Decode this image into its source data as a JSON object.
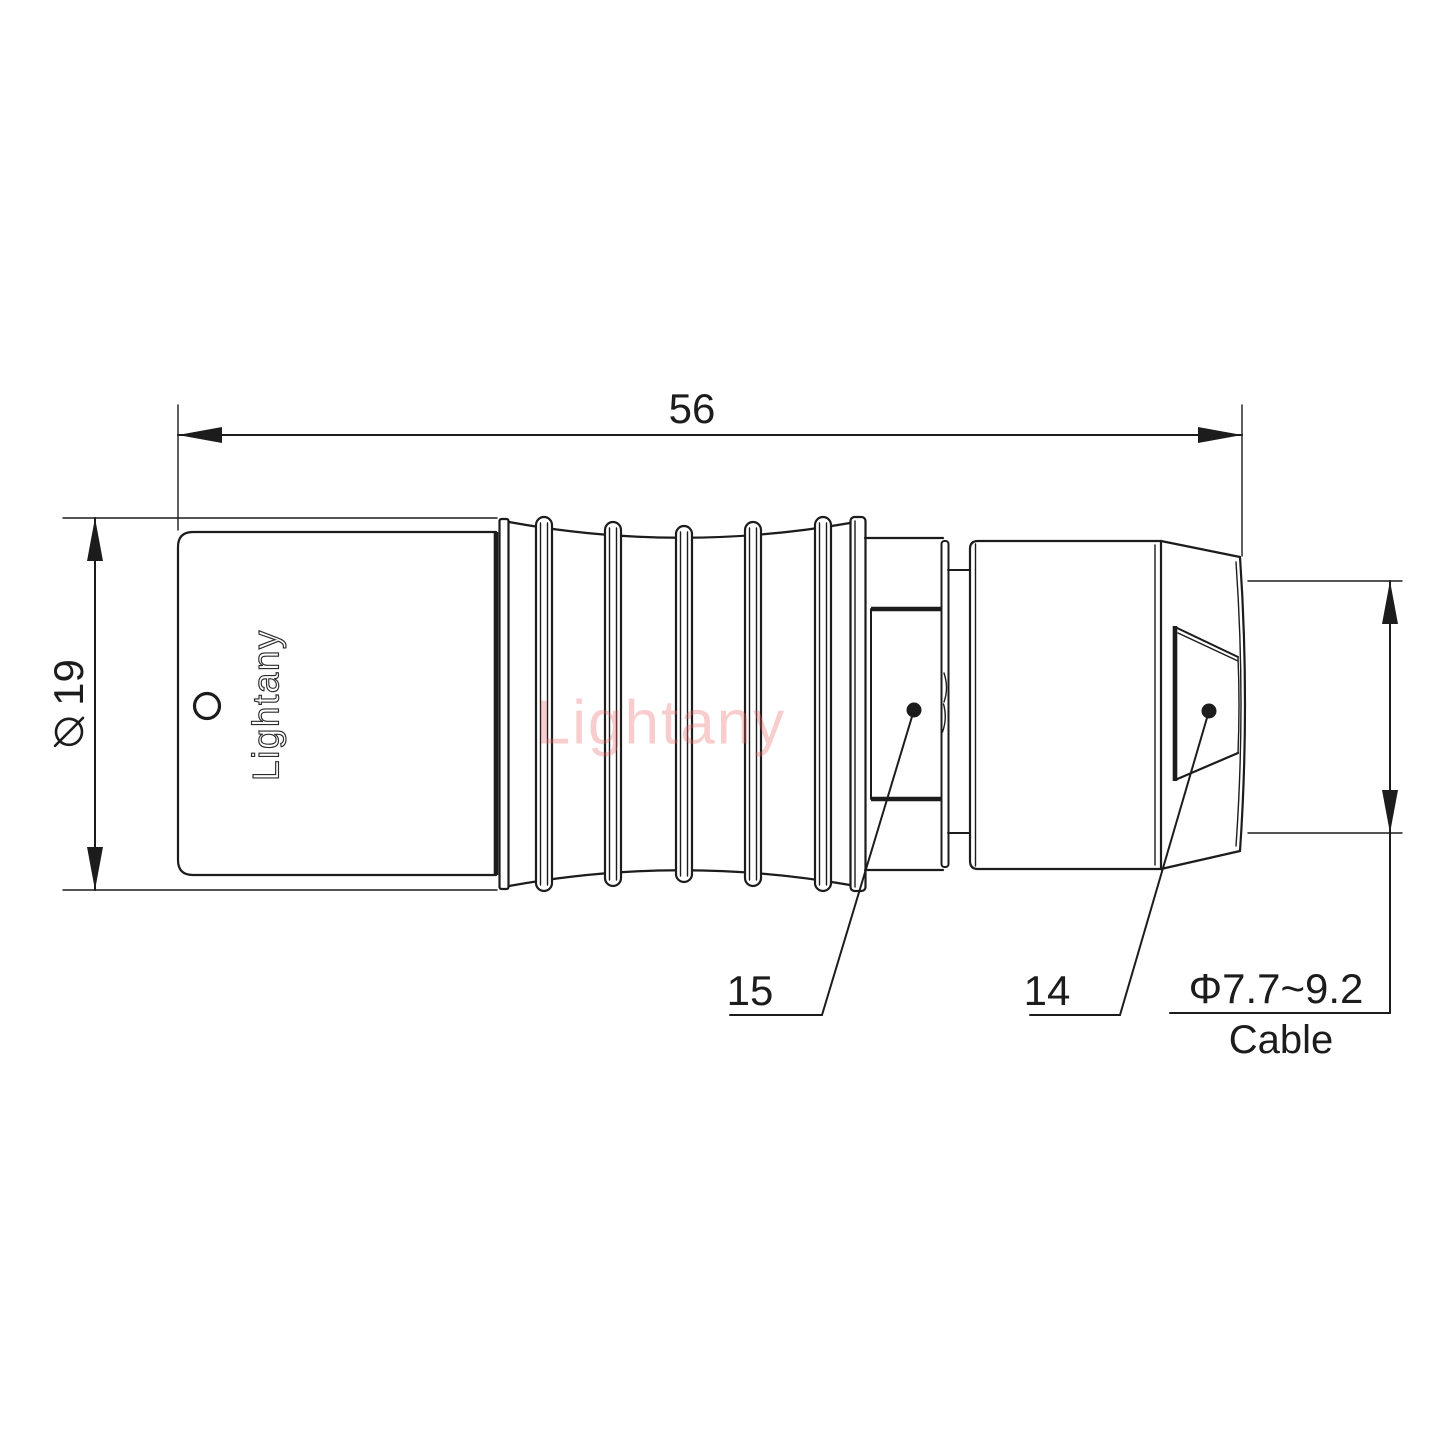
{
  "theme": {
    "bg": "#ffffff",
    "line": "#1c1c1c",
    "watermark": "rgba(233,103,103,0.33)"
  },
  "dimensions": {
    "overall_length": "56",
    "diameter_value": "19",
    "cable_range": "Φ7.7~9.2",
    "cable_label": "Cable"
  },
  "part_labels": {
    "strain_relief": "15",
    "coupling_nut": "14"
  },
  "branding": {
    "engraving": "Lightany",
    "watermark": "Lightany"
  }
}
